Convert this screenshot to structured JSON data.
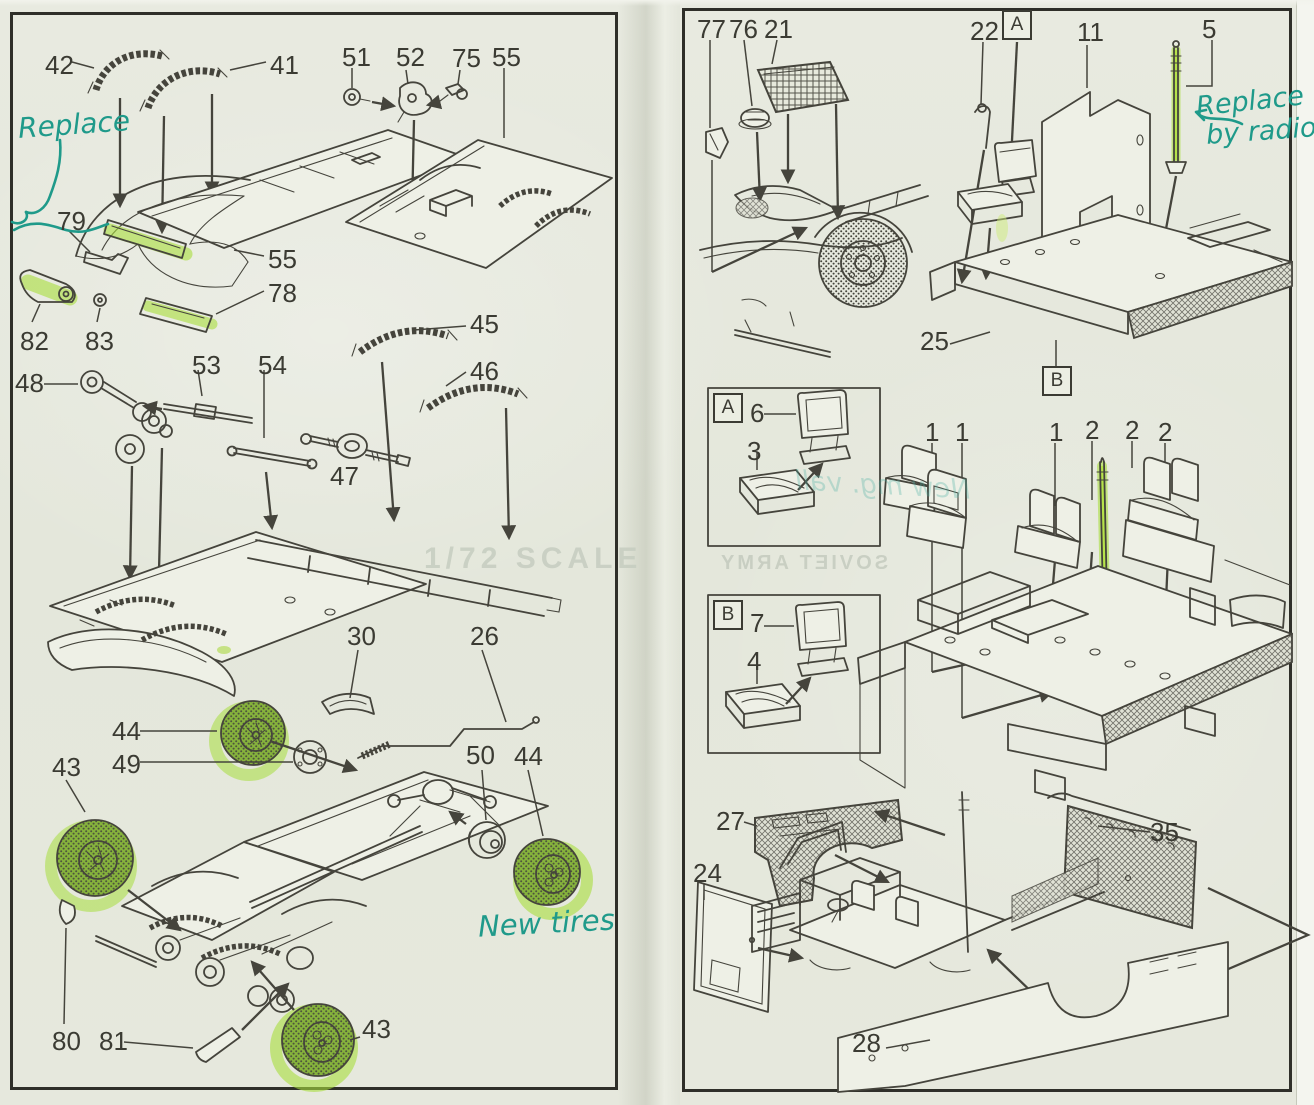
{
  "colors": {
    "paper": "#e6e8dd",
    "ink": "#45443c",
    "highlighter_green": "#a9de3c",
    "marker_teal": "#1f9a8a",
    "panel_border": "#2f2f29"
  },
  "left_panel": {
    "part_labels": {
      "p42": "42",
      "p41": "41",
      "p51": "51",
      "p52": "52",
      "p75": "75",
      "p55_top": "55",
      "p79": "79",
      "p55_side": "55",
      "p78": "78",
      "p82": "82",
      "p83": "83",
      "p48": "48",
      "p53": "53",
      "p54": "54",
      "p45": "45",
      "p46": "46",
      "p47": "47",
      "p30": "30",
      "p26": "26",
      "p44_top": "44",
      "p49": "49",
      "p43_left": "43",
      "p50": "50",
      "p44_right": "44",
      "p80": "80",
      "p81": "81",
      "p43_bottom": "43"
    },
    "handwritten": {
      "replace": "Replace",
      "new_tires": "New tires"
    },
    "bleed_through": {
      "scale_text": "1/72 SCALE"
    }
  },
  "right_panel": {
    "part_labels": {
      "p77": "77",
      "p76": "76",
      "p21": "21",
      "p22": "22",
      "p11": "11",
      "p5": "5",
      "p25": "25",
      "p6": "6",
      "p3": "3",
      "p7": "7",
      "p4": "4",
      "p1_a": "1",
      "p1_b": "1",
      "p1_c": "1",
      "p2_a": "2",
      "p2_b": "2",
      "p2_c": "2",
      "p27": "27",
      "p35": "35",
      "p24": "24",
      "p28": "28"
    },
    "assembly_markers": {
      "a": "A",
      "b": "B"
    },
    "handwritten": {
      "replace": "Replace",
      "by_radio": "by radio"
    },
    "bleed_through": {
      "print_text": "SOVIET ARMY",
      "handwritten_text": "New mg. vall"
    }
  }
}
